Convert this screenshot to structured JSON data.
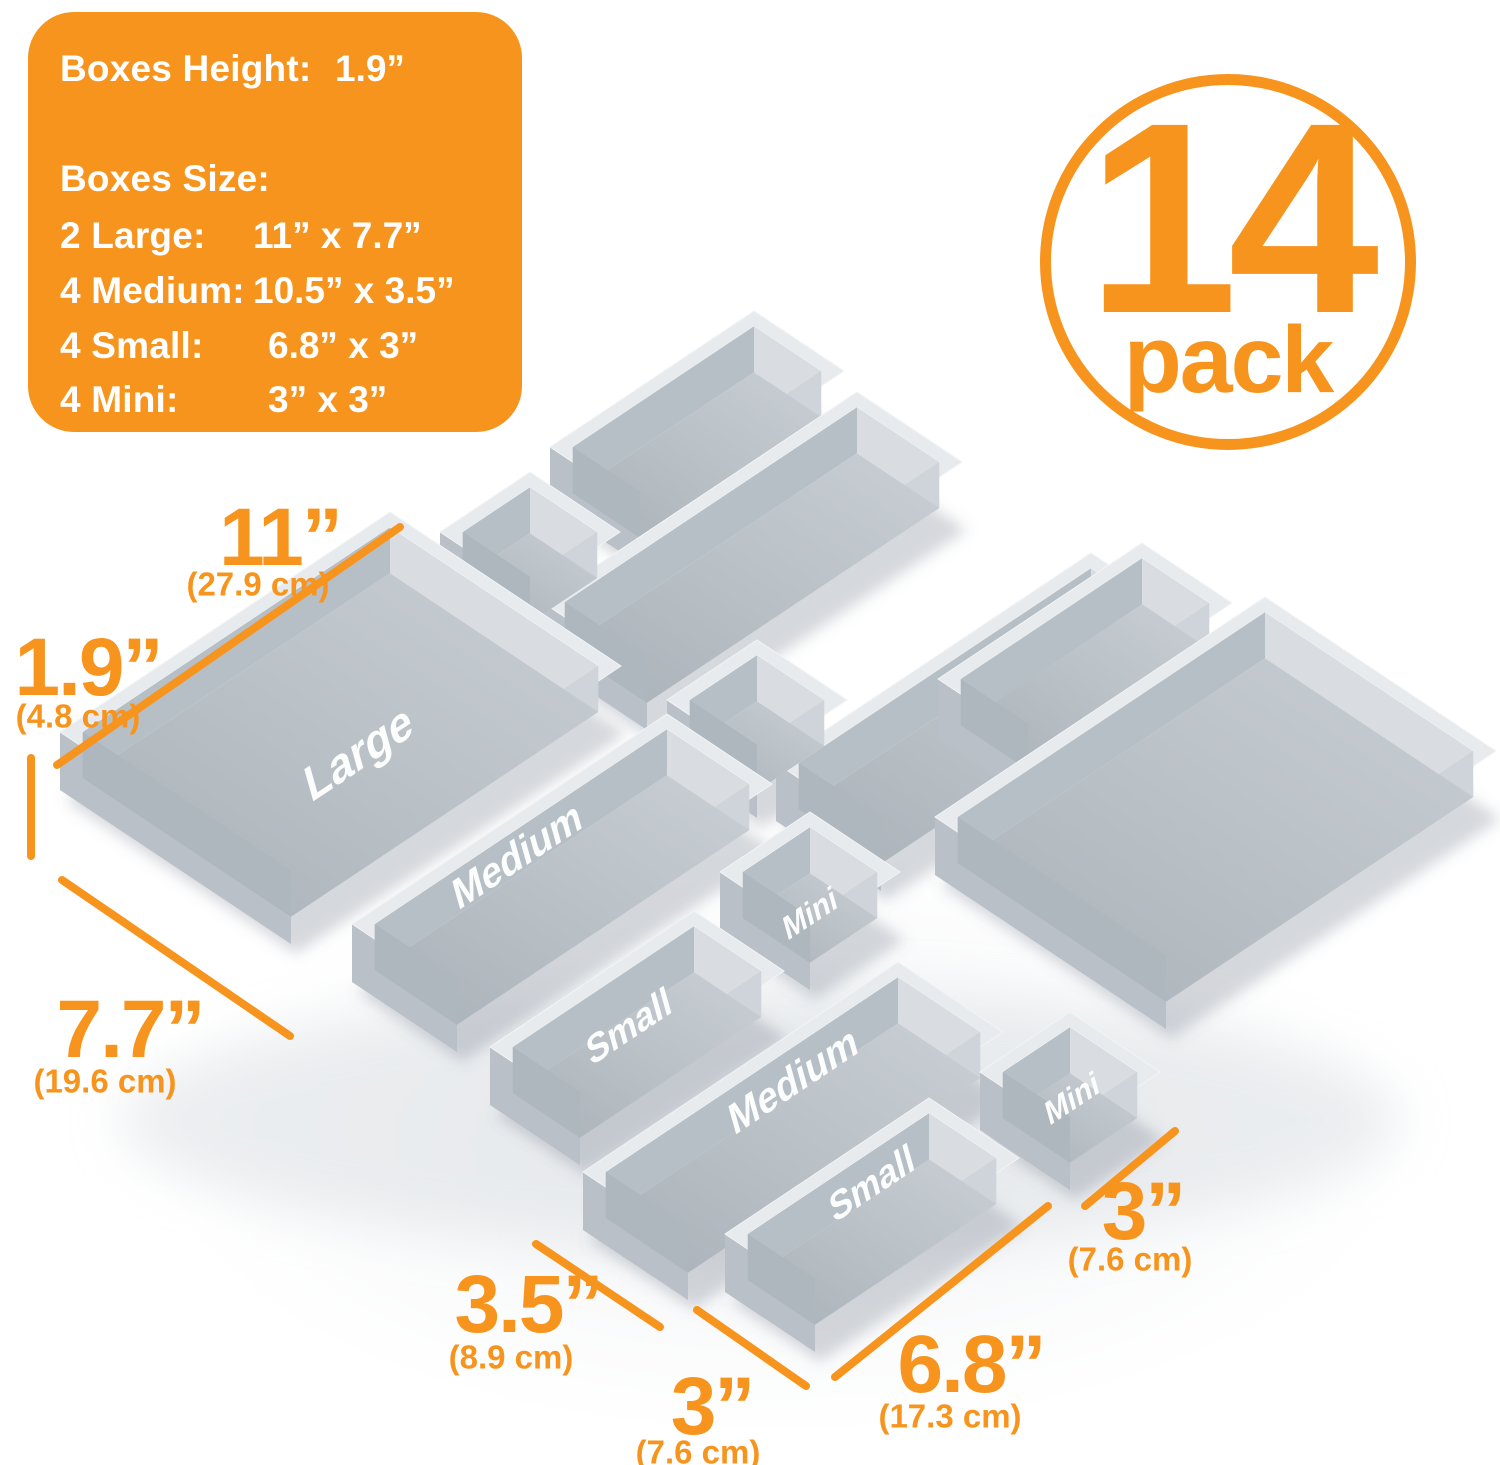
{
  "badge": {
    "number": "14",
    "word": "pack",
    "color": "#f7941d"
  },
  "panel": {
    "background": "#f7941d",
    "height_label": "Boxes Height:",
    "height_value": "1.9”",
    "size_label": "Boxes Size:",
    "rows": [
      {
        "label": "2 Large:",
        "value": "11” x 7.7”"
      },
      {
        "label": "4 Medium:",
        "value": "10.5” x 3.5”"
      },
      {
        "label": "4 Small:",
        "value": "6.8” x 3”"
      },
      {
        "label": "4 Mini:",
        "value": "3” x 3”"
      }
    ]
  },
  "annotations": [
    {
      "id": "len11",
      "value": "11”",
      "metric": "(27.9 cm)"
    },
    {
      "id": "h19",
      "value": "1.9”",
      "metric": "(4.8 cm)"
    },
    {
      "id": "w77",
      "value": "7.7”",
      "metric": "(19.6 cm)"
    },
    {
      "id": "w35",
      "value": "3.5”",
      "metric": "(8.9 cm)"
    },
    {
      "id": "w3b",
      "value": "3”",
      "metric": "(7.6 cm)"
    },
    {
      "id": "l68",
      "value": "6.8”",
      "metric": "(17.3 cm)"
    },
    {
      "id": "w3r",
      "value": "3”",
      "metric": "(7.6 cm)"
    }
  ],
  "sizes": {
    "large": {
      "w": 7.7,
      "d": 11
    },
    "medium": {
      "w": 3.5,
      "d": 10.5
    },
    "small": {
      "w": 3,
      "d": 6.8
    },
    "mini": {
      "w": 3,
      "d": 3
    }
  },
  "boxes": [
    {
      "id": "small1",
      "size": "small",
      "label": ""
    },
    {
      "id": "medium1",
      "size": "medium",
      "label": ""
    },
    {
      "id": "mini1",
      "size": "mini",
      "label": ""
    },
    {
      "id": "medium2",
      "size": "medium",
      "label": ""
    },
    {
      "id": "small4",
      "size": "small",
      "label": ""
    },
    {
      "id": "large2",
      "size": "large",
      "label": ""
    },
    {
      "id": "mini2",
      "size": "mini",
      "label": ""
    },
    {
      "id": "large1",
      "size": "large",
      "label": "Large"
    },
    {
      "id": "medium3",
      "size": "medium",
      "label": "Medium"
    },
    {
      "id": "mini3",
      "size": "mini",
      "label": "Mini"
    },
    {
      "id": "small2",
      "size": "small",
      "label": "Small"
    },
    {
      "id": "medium4",
      "size": "medium",
      "label": "Medium"
    },
    {
      "id": "mini4",
      "size": "mini",
      "label": "Mini"
    },
    {
      "id": "small3",
      "size": "small",
      "label": "Small"
    }
  ],
  "scene_colors": {
    "accent": "#f7941d",
    "wall_south": "#b9c0c7",
    "wall_west": "#d3d8dc",
    "rim_top": "#e8ebee",
    "inner_north": "#d9dde1",
    "inner_east": "#ced4d9",
    "inner_west": "#b7bfc6",
    "inner_south": "#aeb6be",
    "floor_from": "#aab2b9",
    "floor_to": "#c9cfd4",
    "label_color": "#ffffff",
    "shadow": "rgba(105,115,128,0.28)"
  }
}
